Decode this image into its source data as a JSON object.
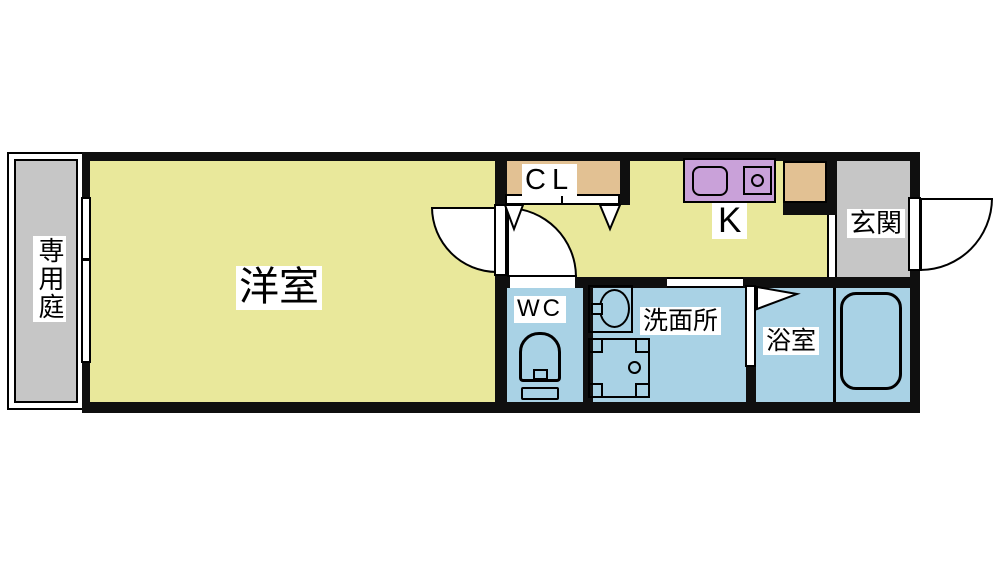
{
  "floorplan": {
    "rooms": {
      "garden": "専用庭",
      "western_room": "洋室",
      "closet": "CL",
      "kitchen": "K",
      "entrance": "玄関",
      "toilet": "WC",
      "washroom": "洗面所",
      "bathroom": "浴室"
    },
    "colors": {
      "room_yellow": "#e9e89b",
      "wet_blue": "#a9d2e5",
      "area_gray": "#c6c6c6",
      "closet_tan": "#e2c193",
      "counter_purple": "#c9a1d9",
      "wall": "#0f0f0f"
    }
  }
}
